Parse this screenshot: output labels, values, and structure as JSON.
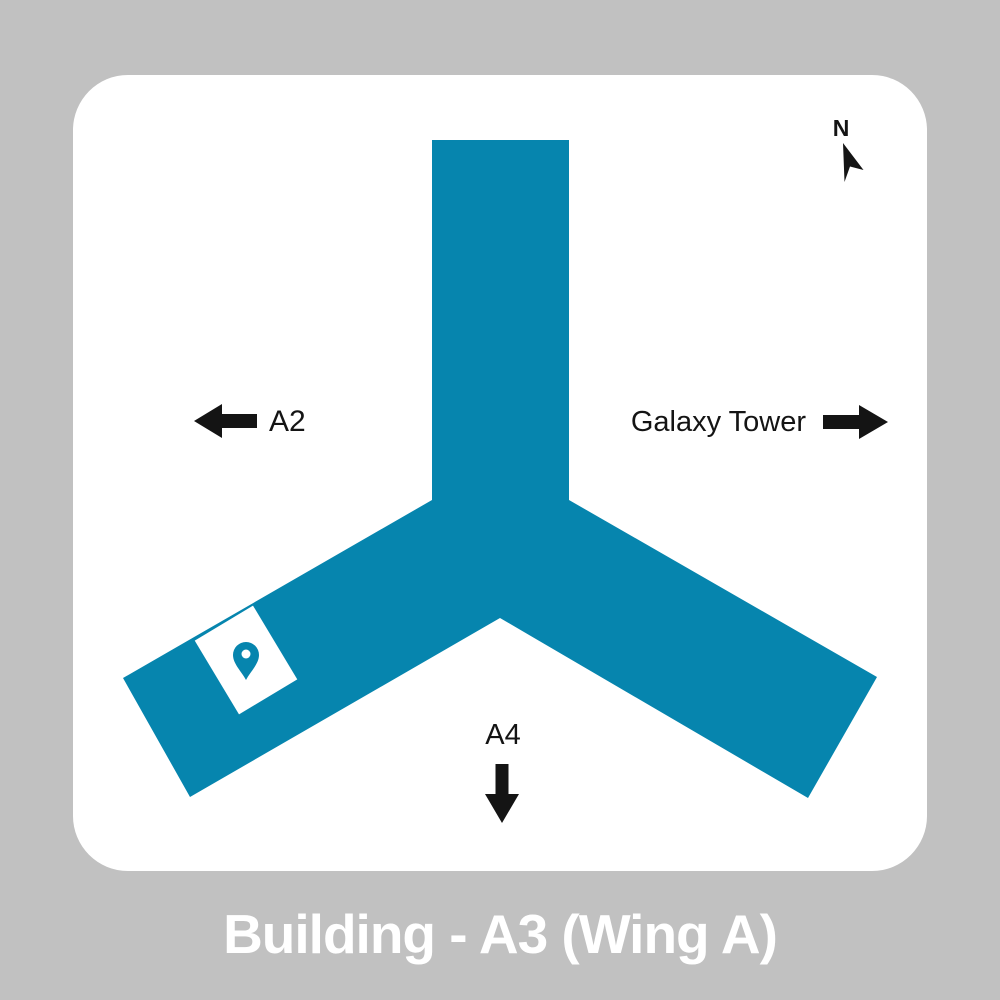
{
  "title": "Building - A3 (Wing A)",
  "compass": {
    "label": "N",
    "icon": "north-arrow-icon"
  },
  "directions": [
    {
      "id": "west",
      "label": "A2",
      "arrow_icon": "arrow-left-icon"
    },
    {
      "id": "east",
      "label": "Galaxy Tower",
      "arrow_icon": "arrow-right-icon"
    },
    {
      "id": "south",
      "label": "A4",
      "arrow_icon": "arrow-down-icon"
    }
  ],
  "map": {
    "marker_icon": "location-pin-icon",
    "building_shape": "y-shaped-wing"
  },
  "colors": {
    "background": "#c1c1c1",
    "card": "#ffffff",
    "building": "#0685ae",
    "ink": "#141414",
    "title_text": "#ffffff"
  }
}
